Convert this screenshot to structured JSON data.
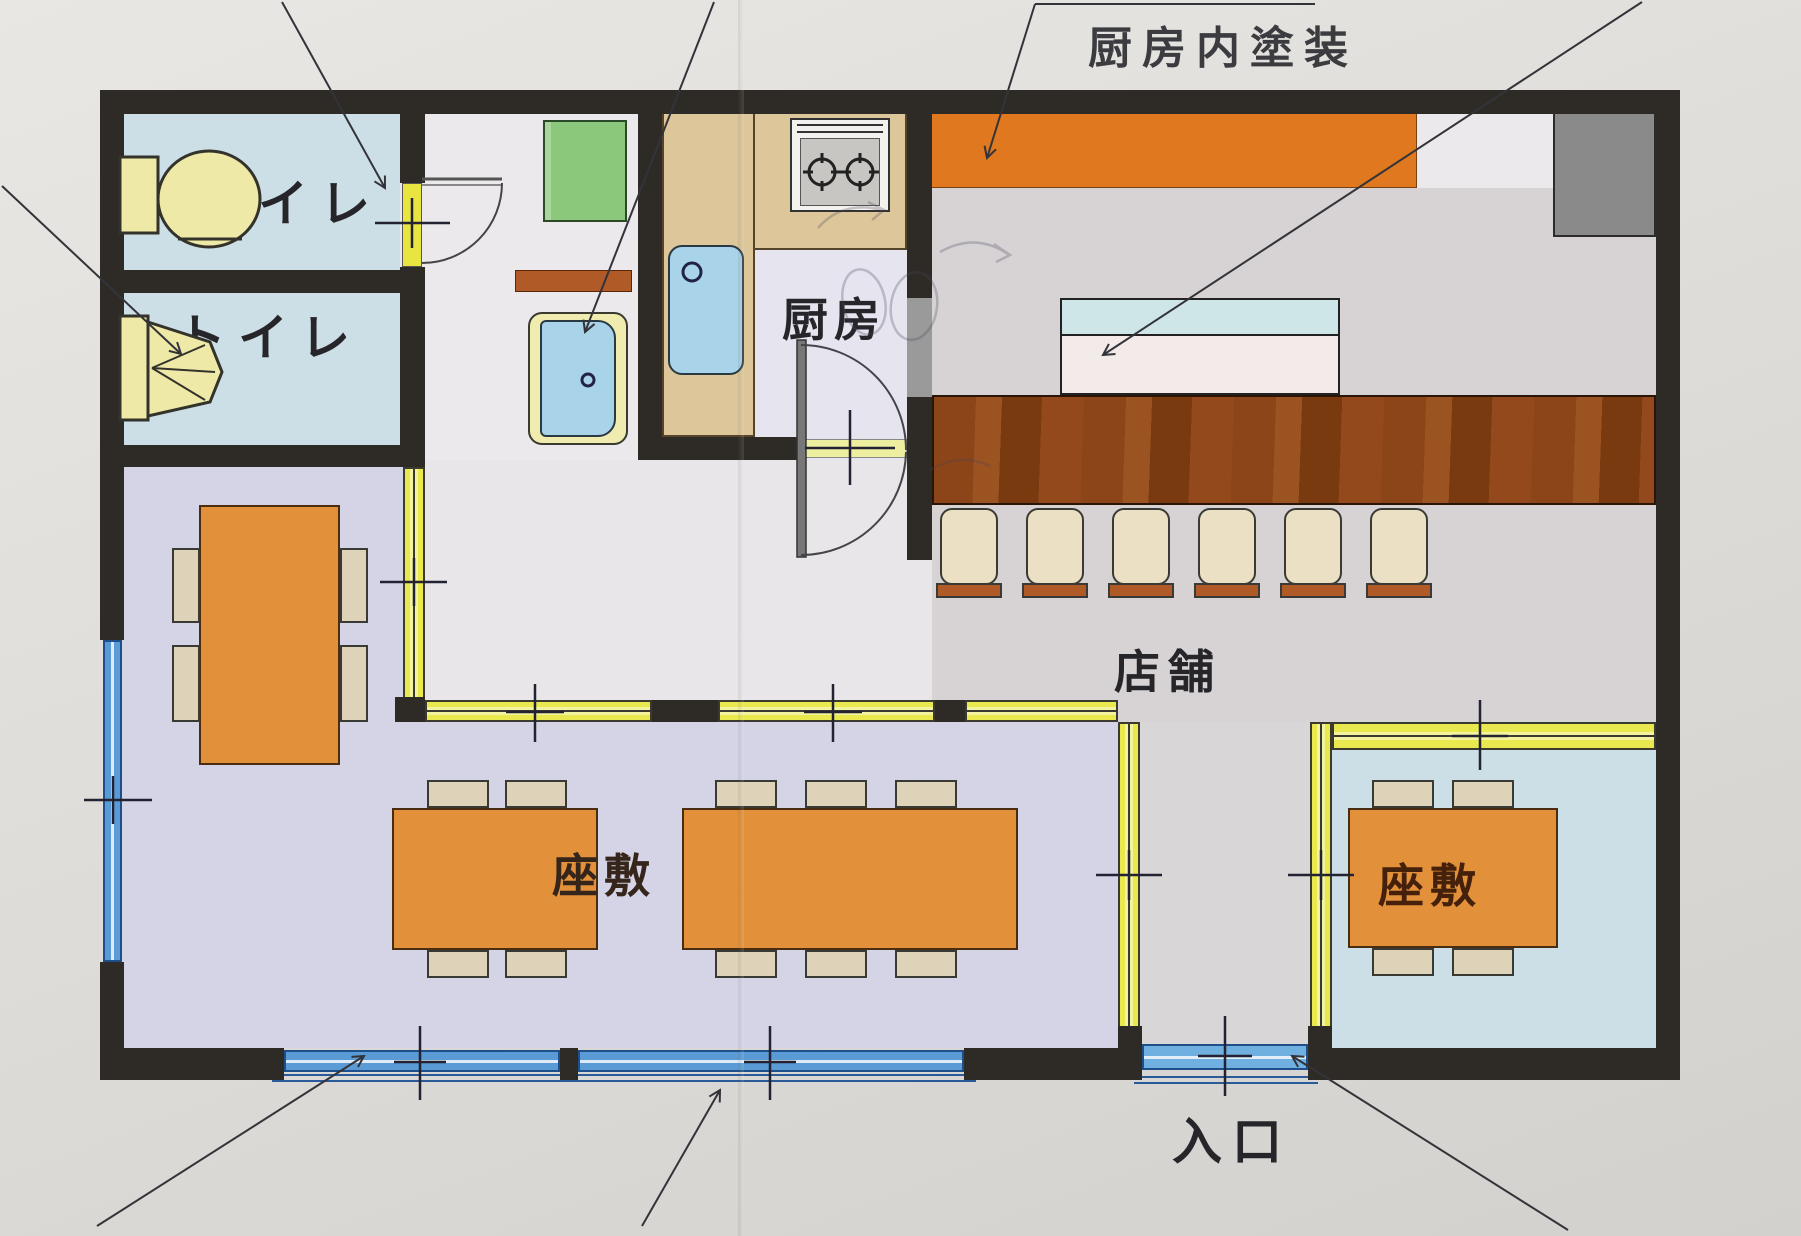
{
  "page": {
    "type": "restaurant-floor-plan",
    "language": "ja"
  },
  "annotations": {
    "kitchen_paint_note": "厨房内塗装"
  },
  "rooms": {
    "toilet1": {
      "label": "トイレ"
    },
    "toilet2": {
      "label": "トイレ"
    },
    "kitchen": {
      "label": "厨房"
    },
    "store": {
      "label": "店舗"
    },
    "zashiki_main": {
      "label": "座敷"
    },
    "zashiki_right": {
      "label": "座敷"
    },
    "entrance": {
      "label": "入口"
    }
  },
  "furniture": {
    "counter_stool_count": 6,
    "zashiki_main_tables": 2,
    "zashiki_right_tables": 1,
    "private_room_tables": 1
  },
  "colors": {
    "wall": "#2e2b26",
    "partition_yellow": "#e9e84e",
    "window_blue": "#5b9bd5",
    "table_orange": "#e2913a",
    "chair_beige": "#ded2b8",
    "counter_wood": "#8c4518",
    "paint_strip_orange": "#e07820",
    "tatami_lavender": "#d5d4e6",
    "room_blue": "#cddfe6",
    "store_gray": "#d7d3d4",
    "fixture_yellow": "#efe9a8"
  }
}
